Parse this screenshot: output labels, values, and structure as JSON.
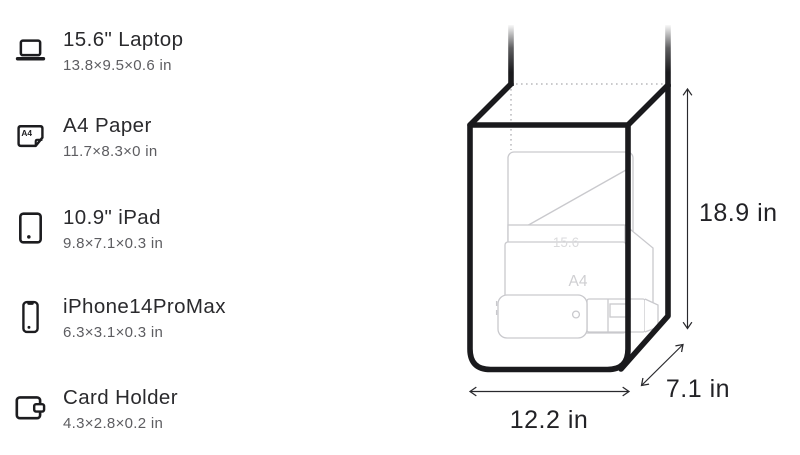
{
  "items": [
    {
      "name": "15.6\" Laptop",
      "dims": "13.8×9.5×0.6 in",
      "icon": "laptop-icon"
    },
    {
      "name": "A4 Paper",
      "dims": "11.7×8.3×0 in",
      "icon": "a4-paper-icon"
    },
    {
      "name": "10.9\" iPad",
      "dims": "9.8×7.1×0.3 in",
      "icon": "ipad-icon"
    },
    {
      "name": "iPhone14ProMax",
      "dims": "6.3×3.1×0.3 in",
      "icon": "iphone-icon"
    },
    {
      "name": "Card Holder",
      "dims": "4.3×2.8×0.2 in",
      "icon": "card-holder-icon"
    }
  ],
  "icons": {
    "a4_label": "A4"
  },
  "diagram": {
    "height_label": "18.9 in",
    "width_label": "12.2 in",
    "depth_label": "7.1 in",
    "inner_laptop_label": "15.6",
    "inner_a4_label": "A4",
    "colors": {
      "outline": "#1a1a1d",
      "faint_content": "#c9c9cd",
      "dimension_ink": "#29292d",
      "hidden_edge": "#b9b9bc"
    }
  }
}
